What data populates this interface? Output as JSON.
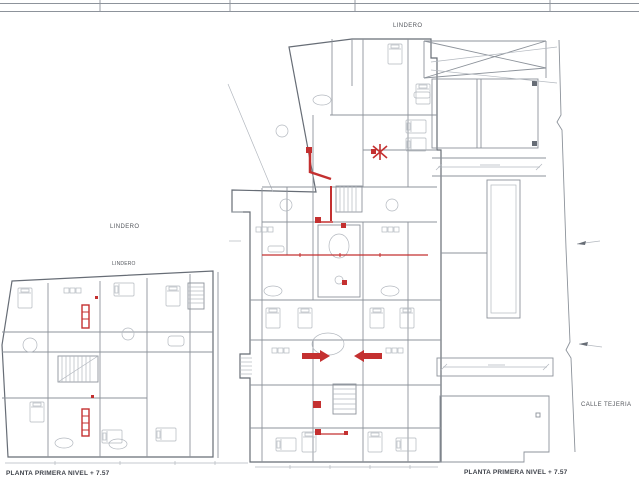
{
  "document": {
    "type": "architectural floor plan drawing",
    "sheet_caption": "PLANTA PRIMERA NIVEL + 7.57"
  },
  "labels": {
    "lindero_top": "LINDERO",
    "lindero_left": "LINDERO",
    "lindero_wing": "LINDERO",
    "calle_tejeria": "CALLE TEJERIA",
    "caption_left": "PLANTA PRIMERA NIVEL + 7.57",
    "caption_right": "PLANTA PRIMERA NIVEL + 7.57"
  },
  "colors": {
    "background": "#ffffff",
    "line_light": "#b3b8bf",
    "line_mid": "#8d939b",
    "line_dark": "#676d76",
    "accent_red": "#c43030",
    "label_text": "#55585e",
    "caption_text": "#3f434b"
  }
}
